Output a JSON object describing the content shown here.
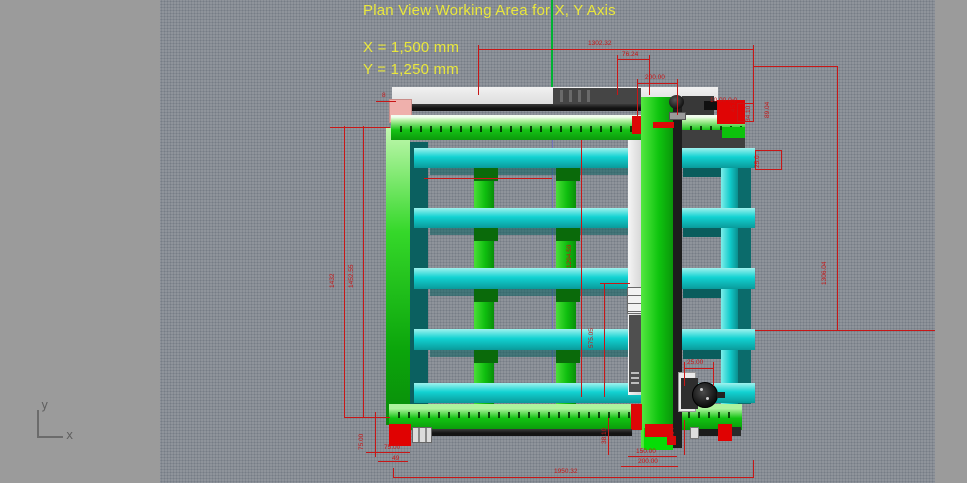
{
  "viewport": {
    "title": "Plan View Working Area for X, Y Axis",
    "working_area_x": "X = 1,500 mm",
    "working_area_y": "Y = 1,250 mm"
  },
  "axis_gizmo": {
    "y_label": "y",
    "x_label": "x"
  },
  "colors": {
    "background": "#8f949b",
    "panel": "#9b9b9b",
    "annotation_yellow": "#e9e73b",
    "dimension_red": "#c81616",
    "frame_green": "#12c312",
    "beam_cyan": "#12d2d2",
    "centerline_green": "#00b232"
  },
  "dimension_labels": [
    {
      "t": "1302.32",
      "x": 588,
      "y": 40,
      "r": 0
    },
    {
      "t": "76.24",
      "x": 622,
      "y": 51,
      "r": 0
    },
    {
      "t": "200.00",
      "x": 645,
      "y": 74,
      "r": 0
    },
    {
      "t": "10.00 0.0",
      "x": 710,
      "y": 97,
      "r": 0
    },
    {
      "t": "45.0",
      "x": 738,
      "y": 104,
      "r": 1
    },
    {
      "t": "34.10",
      "x": 753,
      "y": 114,
      "r": 1
    },
    {
      "t": "89.04",
      "x": 772,
      "y": 110,
      "r": 1
    },
    {
      "t": "25.0",
      "x": 762,
      "y": 160,
      "r": 1
    },
    {
      "t": "1306.04",
      "x": 829,
      "y": 277,
      "r": 1
    },
    {
      "t": "8",
      "x": 382,
      "y": 92,
      "r": 0
    },
    {
      "t": "1432",
      "x": 337,
      "y": 280,
      "r": 1
    },
    {
      "t": "1452.55",
      "x": 356,
      "y": 280,
      "r": 1
    },
    {
      "t": "1294.59",
      "x": 574,
      "y": 260,
      "r": 1
    },
    {
      "t": "575.05",
      "x": 596,
      "y": 340,
      "r": 1
    },
    {
      "t": "75.00",
      "x": 366,
      "y": 442,
      "r": 1
    },
    {
      "t": "75.00",
      "x": 384,
      "y": 444,
      "r": 0
    },
    {
      "t": "49",
      "x": 392,
      "y": 455,
      "r": 0
    },
    {
      "t": "38.10",
      "x": 609,
      "y": 436,
      "r": 1
    },
    {
      "t": "40.64",
      "x": 677,
      "y": 436,
      "r": 1
    },
    {
      "t": "150.00",
      "x": 636,
      "y": 448,
      "r": 0
    },
    {
      "t": "200.00",
      "x": 638,
      "y": 458,
      "r": 0
    },
    {
      "t": "25.00",
      "x": 687,
      "y": 359,
      "r": 0
    },
    {
      "t": "1950.32",
      "x": 554,
      "y": 468,
      "r": 0
    }
  ]
}
